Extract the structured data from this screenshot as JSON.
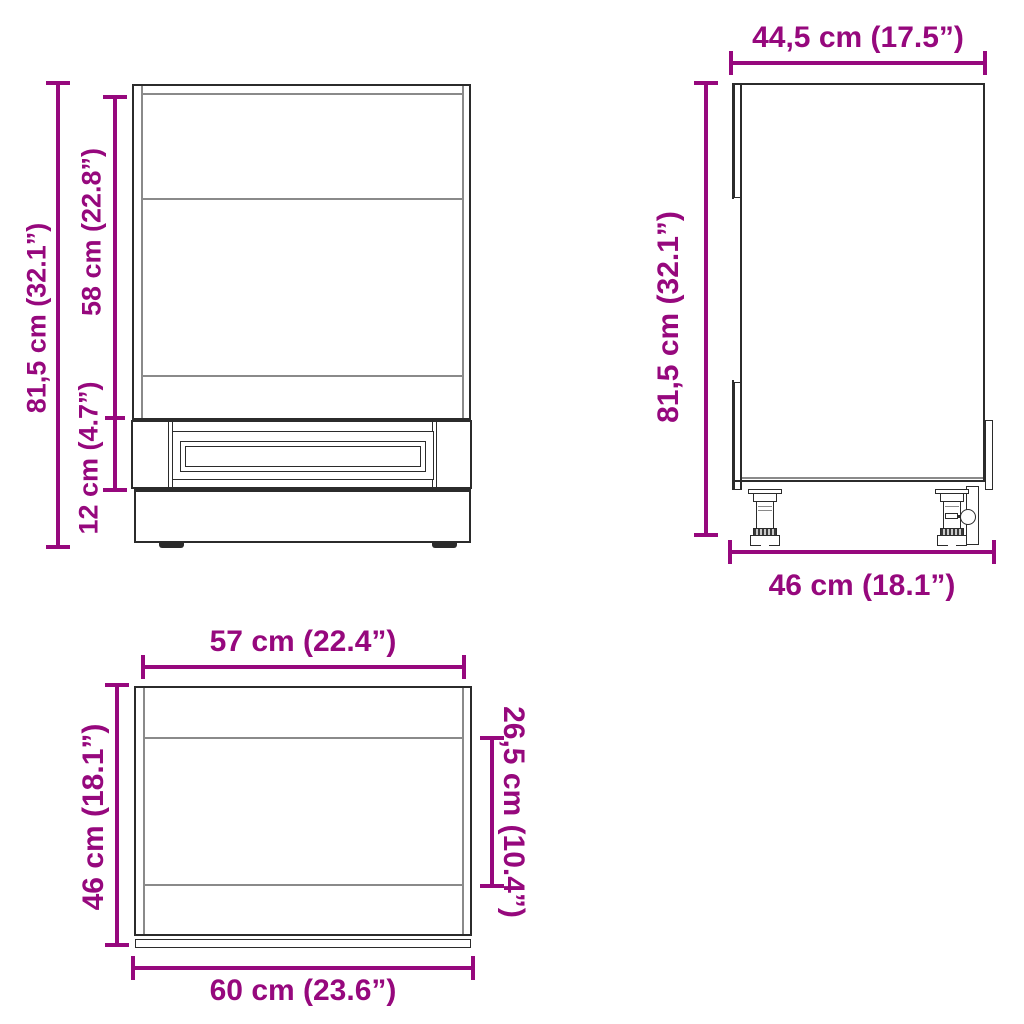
{
  "colors": {
    "accent": "#96087D",
    "line": "#2b2b2b",
    "thin": "#8a8a8a"
  },
  "views": {
    "front": {
      "title": "cabinet front elevation",
      "dims": {
        "height_total": "81,5 cm (32.1”)",
        "height_body": "58 cm (22.8”)",
        "height_plinth": "12 cm (4.7”)"
      }
    },
    "side": {
      "title": "cabinet side elevation",
      "dims": {
        "depth_top": "44,5 cm (17.5”)",
        "height_total": "81,5 cm (32.1”)",
        "depth_bottom": "46 cm (18.1”)"
      }
    },
    "plan": {
      "title": "cabinet top view",
      "dims": {
        "width_inner": "57 cm (22.4”)",
        "depth_left": "46 cm (18.1”)",
        "depth_partial": "26,5 cm (10.4”)",
        "width_outer": "60 cm (23.6”)"
      }
    }
  }
}
